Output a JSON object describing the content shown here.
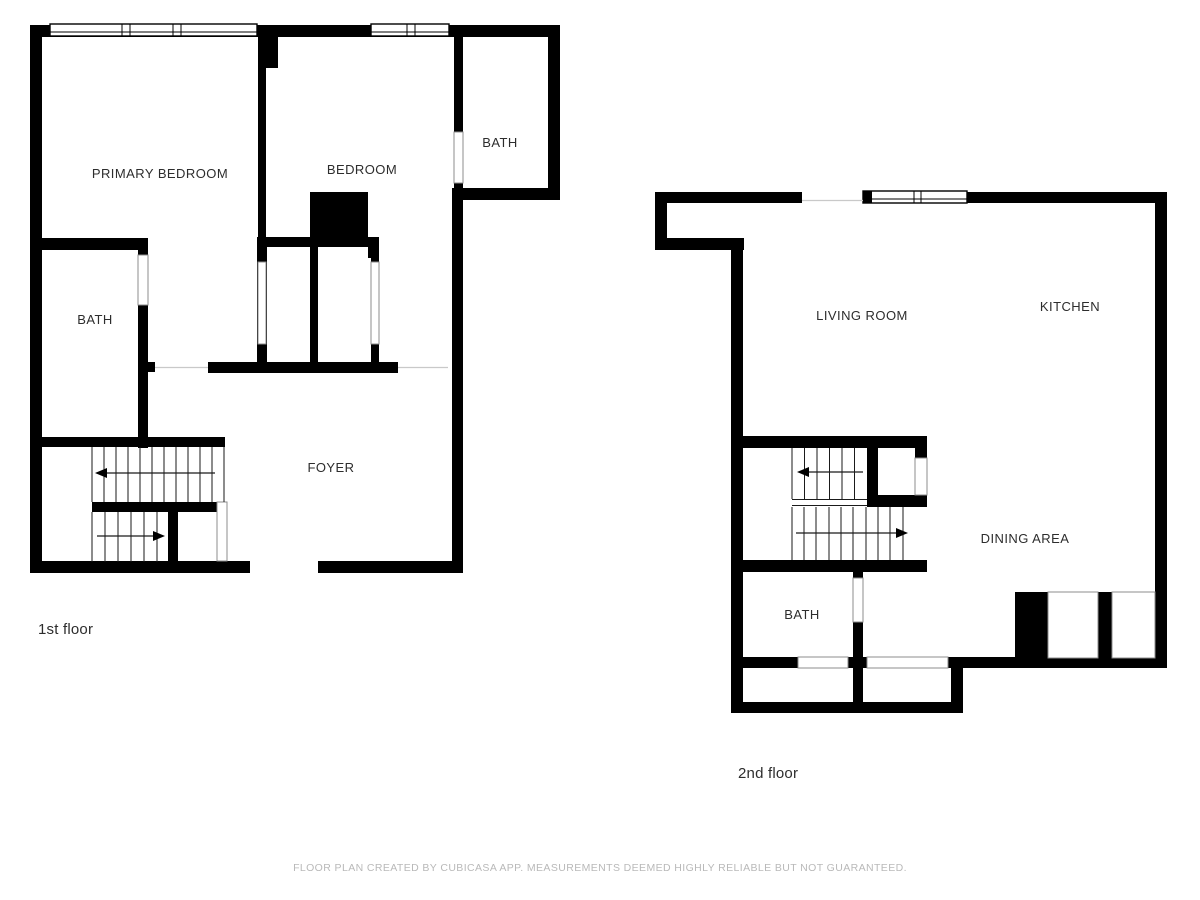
{
  "page": {
    "background": "#ffffff"
  },
  "colors": {
    "wall": "#000000",
    "label": "#2d2d2d",
    "footer_text": "#b9b9b9",
    "door_outline": "#8c8c8c",
    "threshold_line": "#c9c9c9"
  },
  "floors": [
    {
      "caption": "1st floor",
      "rooms": [
        {
          "name": "primary-bedroom",
          "label": "PRIMARY BEDROOM"
        },
        {
          "name": "bedroom",
          "label": "BEDROOM"
        },
        {
          "name": "bath-upper-right",
          "label": "BATH"
        },
        {
          "name": "bath-left",
          "label": "BATH"
        },
        {
          "name": "foyer",
          "label": "FOYER"
        }
      ]
    },
    {
      "caption": "2nd floor",
      "rooms": [
        {
          "name": "living-room",
          "label": "LIVING ROOM"
        },
        {
          "name": "kitchen",
          "label": "KITCHEN"
        },
        {
          "name": "dining-area",
          "label": "DINING AREA"
        },
        {
          "name": "bath",
          "label": "BATH"
        }
      ]
    }
  ],
  "footer": {
    "disclaimer": "FLOOR PLAN CREATED BY CUBICASA APP. MEASUREMENTS DEEMED HIGHLY RELIABLE BUT NOT GUARANTEED."
  }
}
